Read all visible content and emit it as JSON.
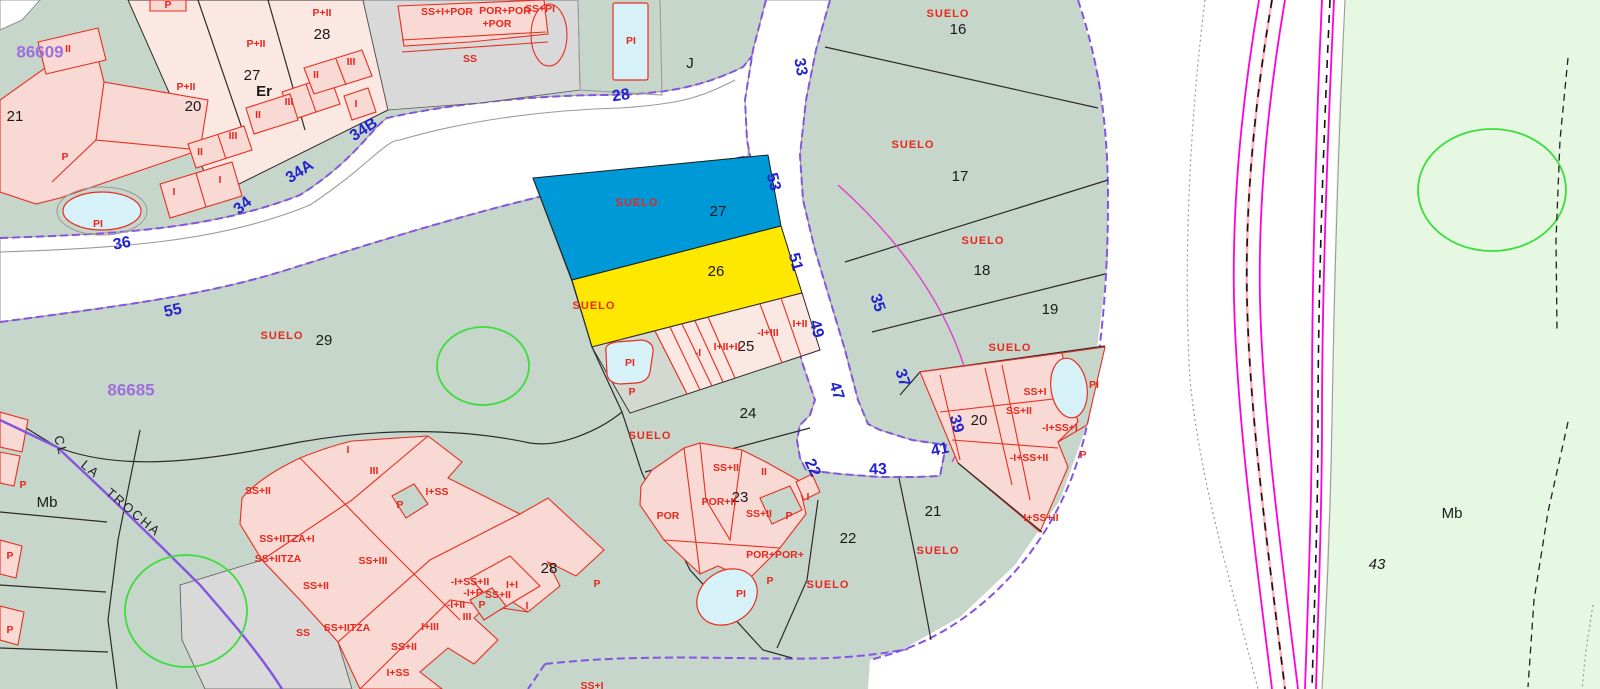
{
  "map": {
    "title": "cadastral-parcel-map",
    "colors": {
      "parcel_teal": "#c6d6cb",
      "zone_light_green": "#e6f7e2",
      "building_pink": "#fce8e2",
      "building_outline_red": "#e92e20",
      "highlight_blue_parcel": "#0099d8",
      "highlight_yellow_parcel": "#ffe800",
      "street_number_blue": "#2323cd",
      "boundary_purple": "#8455e0",
      "utility_magenta": "#ff00dd",
      "pool_blue": "#d6f1f7",
      "vegetation_green": "#3ddd3d",
      "gray_parcel": "#d9d9d9"
    },
    "map_refs": [
      {
        "t": "86609",
        "x": 40,
        "y": 53
      },
      {
        "t": "86685",
        "x": 131,
        "y": 391
      }
    ],
    "street_numbers": [
      {
        "t": "28",
        "x": 621,
        "y": 96,
        "r": -8
      },
      {
        "t": "33",
        "x": 800,
        "y": 67,
        "r": 80
      },
      {
        "t": "53",
        "x": 773,
        "y": 182,
        "r": 75
      },
      {
        "t": "51",
        "x": 795,
        "y": 262,
        "r": 75
      },
      {
        "t": "49",
        "x": 816,
        "y": 329,
        "r": 75
      },
      {
        "t": "47",
        "x": 836,
        "y": 391,
        "r": 72
      },
      {
        "t": "35",
        "x": 877,
        "y": 303,
        "r": 72
      },
      {
        "t": "37",
        "x": 902,
        "y": 378,
        "r": 72
      },
      {
        "t": "39",
        "x": 956,
        "y": 424,
        "r": 75
      },
      {
        "t": "41",
        "x": 940,
        "y": 450,
        "r": -12
      },
      {
        "t": "43",
        "x": 878,
        "y": 470,
        "r": -2
      },
      {
        "t": "22",
        "x": 812,
        "y": 468,
        "r": 65
      },
      {
        "t": "34B",
        "x": 364,
        "y": 130,
        "r": -33
      },
      {
        "t": "34A",
        "x": 300,
        "y": 172,
        "r": -33
      },
      {
        "t": "34",
        "x": 243,
        "y": 206,
        "r": -40
      },
      {
        "t": "36",
        "x": 122,
        "y": 244,
        "r": -10
      },
      {
        "t": "55",
        "x": 173,
        "y": 311,
        "r": -12
      }
    ],
    "parcel_numbers": [
      {
        "t": "21",
        "x": 15,
        "y": 117
      },
      {
        "t": "20",
        "x": 193,
        "y": 107
      },
      {
        "t": "27",
        "x": 252,
        "y": 76
      },
      {
        "t": "28",
        "x": 322,
        "y": 35
      },
      {
        "t": "16",
        "x": 958,
        "y": 30
      },
      {
        "t": "17",
        "x": 960,
        "y": 177
      },
      {
        "t": "18",
        "x": 982,
        "y": 271
      },
      {
        "t": "19",
        "x": 1050,
        "y": 310
      },
      {
        "t": "29",
        "x": 324,
        "y": 341
      },
      {
        "t": "27",
        "x": 718,
        "y": 212
      },
      {
        "t": "26",
        "x": 716,
        "y": 272
      },
      {
        "t": "25",
        "x": 746,
        "y": 347
      },
      {
        "t": "24",
        "x": 748,
        "y": 414
      },
      {
        "t": "23",
        "x": 740,
        "y": 498
      },
      {
        "t": "22",
        "x": 848,
        "y": 539
      },
      {
        "t": "21",
        "x": 933,
        "y": 512
      },
      {
        "t": "20",
        "x": 979,
        "y": 421
      },
      {
        "t": "28",
        "x": 549,
        "y": 569
      }
    ],
    "suelo_labels": [
      {
        "t": "SUELO",
        "x": 948,
        "y": 14
      },
      {
        "t": "SUELO",
        "x": 913,
        "y": 145
      },
      {
        "t": "SUELO",
        "x": 983,
        "y": 241
      },
      {
        "t": "SUELO",
        "x": 1010,
        "y": 348
      },
      {
        "t": "SUELO",
        "x": 637,
        "y": 203
      },
      {
        "t": "SUELO",
        "x": 594,
        "y": 306
      },
      {
        "t": "SUELO",
        "x": 282,
        "y": 336
      },
      {
        "t": "SUELO",
        "x": 650,
        "y": 436
      },
      {
        "t": "SUELO",
        "x": 828,
        "y": 585
      },
      {
        "t": "SUELO",
        "x": 938,
        "y": 551
      }
    ],
    "building_labels": [
      {
        "t": "P",
        "x": 168,
        "y": 5
      },
      {
        "t": "II",
        "x": 68,
        "y": 49
      },
      {
        "t": "P+II",
        "x": 186,
        "y": 87
      },
      {
        "t": "P+II",
        "x": 256,
        "y": 44
      },
      {
        "t": "P+II",
        "x": 322,
        "y": 13
      },
      {
        "t": "II",
        "x": 316,
        "y": 75
      },
      {
        "t": "III",
        "x": 351,
        "y": 62
      },
      {
        "t": "I",
        "x": 356,
        "y": 104
      },
      {
        "t": "III",
        "x": 289,
        "y": 102
      },
      {
        "t": "II",
        "x": 258,
        "y": 115
      },
      {
        "t": "III",
        "x": 233,
        "y": 136
      },
      {
        "t": "II",
        "x": 200,
        "y": 152
      },
      {
        "t": "I",
        "x": 220,
        "y": 180
      },
      {
        "t": "I",
        "x": 174,
        "y": 192
      },
      {
        "t": "P",
        "x": 65,
        "y": 157
      },
      {
        "t": "PI",
        "x": 98,
        "y": 224
      },
      {
        "t": "SS+I+POR",
        "x": 447,
        "y": 12
      },
      {
        "t": "POR+POR",
        "x": 505,
        "y": 11
      },
      {
        "t": "+POR",
        "x": 497,
        "y": 24
      },
      {
        "t": "SS",
        "x": 470,
        "y": 59
      },
      {
        "t": "SS+PI",
        "x": 540,
        "y": 9
      },
      {
        "t": "PI",
        "x": 631,
        "y": 41
      },
      {
        "t": "PI",
        "x": 630,
        "y": 363
      },
      {
        "t": "P",
        "x": 632,
        "y": 392
      },
      {
        "t": "-I",
        "x": 698,
        "y": 353
      },
      {
        "t": "I+II+II",
        "x": 727,
        "y": 347
      },
      {
        "t": "-I+III",
        "x": 768,
        "y": 333
      },
      {
        "t": "I+II",
        "x": 800,
        "y": 324
      },
      {
        "t": "SS+II",
        "x": 726,
        "y": 468
      },
      {
        "t": "II",
        "x": 764,
        "y": 472
      },
      {
        "t": "POR+II",
        "x": 719,
        "y": 502
      },
      {
        "t": "POR",
        "x": 668,
        "y": 516
      },
      {
        "t": "SS+II",
        "x": 759,
        "y": 514
      },
      {
        "t": "P",
        "x": 789,
        "y": 516
      },
      {
        "t": "I",
        "x": 808,
        "y": 497
      },
      {
        "t": "POR+POR+",
        "x": 775,
        "y": 555
      },
      {
        "t": "P",
        "x": 770,
        "y": 581
      },
      {
        "t": "PI",
        "x": 741,
        "y": 594
      },
      {
        "t": "SS+I",
        "x": 1035,
        "y": 392
      },
      {
        "t": "SS+II",
        "x": 1019,
        "y": 411
      },
      {
        "t": "-I+SS+I",
        "x": 1060,
        "y": 428
      },
      {
        "t": "-I+SS+II",
        "x": 1029,
        "y": 458
      },
      {
        "t": "I+SS+II",
        "x": 1041,
        "y": 518
      },
      {
        "t": "P",
        "x": 1083,
        "y": 455
      },
      {
        "t": "PI",
        "x": 1094,
        "y": 385
      },
      {
        "t": "I",
        "x": 348,
        "y": 450
      },
      {
        "t": "III",
        "x": 374,
        "y": 471
      },
      {
        "t": "SS+II",
        "x": 258,
        "y": 491
      },
      {
        "t": "P",
        "x": 400,
        "y": 505
      },
      {
        "t": "I+SS",
        "x": 437,
        "y": 492
      },
      {
        "t": "SS+IITZA+I",
        "x": 287,
        "y": 539
      },
      {
        "t": "SS+IITZA",
        "x": 278,
        "y": 559
      },
      {
        "t": "SS+III",
        "x": 373,
        "y": 561
      },
      {
        "t": "SS+II",
        "x": 316,
        "y": 586
      },
      {
        "t": "SS",
        "x": 303,
        "y": 633
      },
      {
        "t": "SS+IITZA",
        "x": 347,
        "y": 628
      },
      {
        "t": "-I+SS+II",
        "x": 470,
        "y": 582
      },
      {
        "t": "I+I",
        "x": 512,
        "y": 585
      },
      {
        "t": "-I+P",
        "x": 473,
        "y": 593
      },
      {
        "t": "SS+II",
        "x": 498,
        "y": 595
      },
      {
        "t": "-I+II",
        "x": 456,
        "y": 605
      },
      {
        "t": "P",
        "x": 482,
        "y": 605
      },
      {
        "t": "I",
        "x": 527,
        "y": 606
      },
      {
        "t": "III",
        "x": 467,
        "y": 617
      },
      {
        "t": "I+III",
        "x": 430,
        "y": 627
      },
      {
        "t": "SS+II",
        "x": 404,
        "y": 647
      },
      {
        "t": "I+SS",
        "x": 398,
        "y": 673
      },
      {
        "t": "P",
        "x": 597,
        "y": 584
      },
      {
        "t": "P",
        "x": 23,
        "y": 485
      },
      {
        "t": "P",
        "x": 10,
        "y": 556
      },
      {
        "t": "P",
        "x": 10,
        "y": 630
      },
      {
        "t": "SS+I",
        "x": 592,
        "y": 686
      }
    ],
    "street_name_parts": [
      {
        "t": "CL",
        "x": 60,
        "y": 446,
        "r": 75
      },
      {
        "t": "LA",
        "x": 90,
        "y": 470,
        "r": 40
      },
      {
        "t": "TROCHA",
        "x": 133,
        "y": 513,
        "r": 40
      }
    ],
    "misc_labels": [
      {
        "t": "J",
        "x": 690,
        "y": 64,
        "size": 15
      },
      {
        "t": "Er",
        "x": 264,
        "y": 92,
        "size": 19,
        "bold": true
      },
      {
        "t": "Mb",
        "x": 47,
        "y": 503,
        "size": 15
      },
      {
        "t": "Mb",
        "x": 1452,
        "y": 514,
        "size": 16
      },
      {
        "t": "43",
        "x": 1377,
        "y": 565,
        "size": 13,
        "italic": true
      }
    ]
  }
}
